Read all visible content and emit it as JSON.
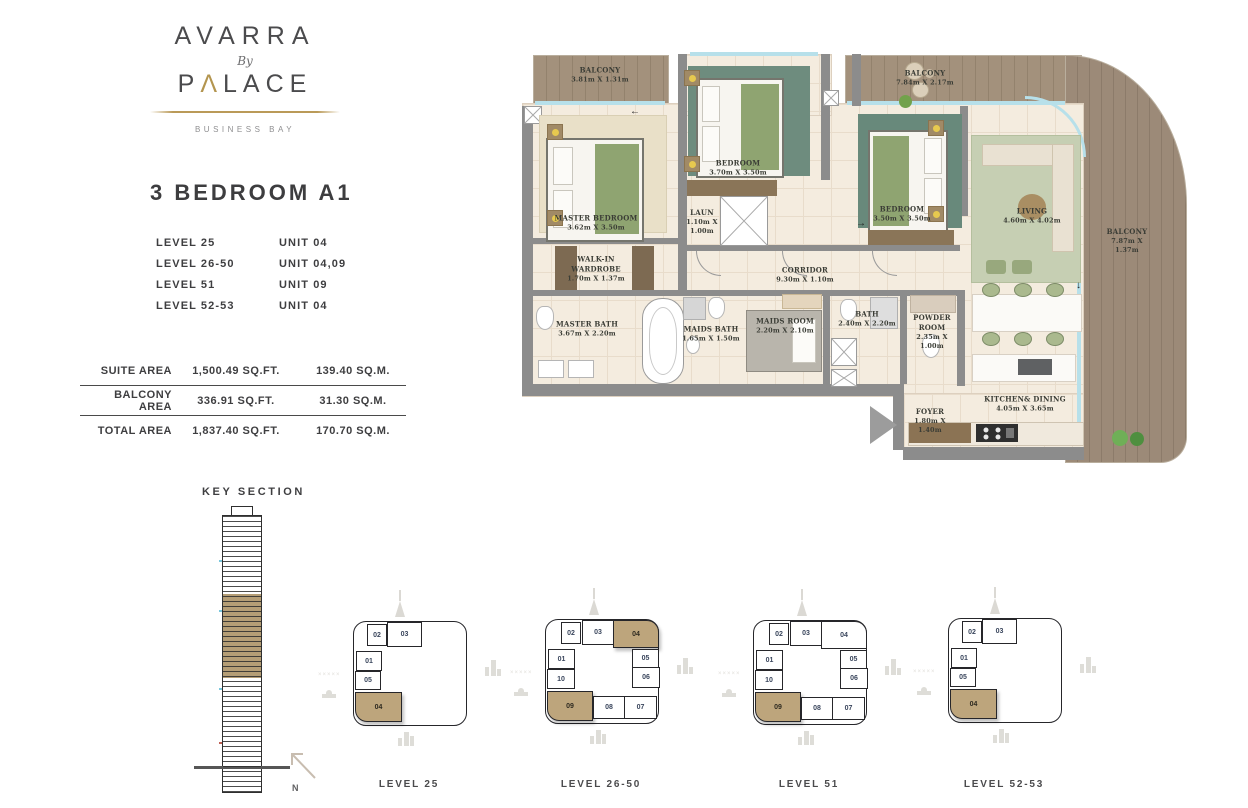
{
  "brand": {
    "name": "AVARRA",
    "by": "By",
    "palace_p": "P",
    "palace_arch": "Λ",
    "palace_rest": "LACE",
    "location": "BUSINESS BAY"
  },
  "page": {
    "title": "3 BEDROOM A1"
  },
  "levels": [
    {
      "level": "LEVEL 25",
      "unit": "UNIT 04"
    },
    {
      "level": "LEVEL 26-50",
      "unit": "UNIT 04,09"
    },
    {
      "level": "LEVEL 51",
      "unit": "UNIT 09"
    },
    {
      "level": "LEVEL 52-53",
      "unit": "UNIT 04"
    }
  ],
  "areas": [
    {
      "label": "SUITE AREA",
      "sqft": "1,500.49 SQ.FT.",
      "sqm": "139.40 SQ.M."
    },
    {
      "label": "BALCONY AREA",
      "sqft": "336.91 SQ.FT.",
      "sqm": "31.30 SQ.M."
    },
    {
      "label": "TOTAL AREA",
      "sqft": "1,837.40 SQ.FT.",
      "sqm": "170.70 SQ.M."
    }
  ],
  "key_section_title": "KEY SECTION",
  "compass": "N",
  "plan": {
    "rooms": [
      {
        "name": "BALCONY",
        "dims": "3.81m X 1.31m"
      },
      {
        "name": "BEDROOM",
        "dims": "3.70m X 3.50m"
      },
      {
        "name": "BALCONY",
        "dims": "7.84m X 2.17m"
      },
      {
        "name": "MASTER BEDROOM",
        "dims": "3.62m X 3.50m"
      },
      {
        "name": "BEDROOM",
        "dims": "3.50m X 3.50m"
      },
      {
        "name": "LIVING",
        "dims": "4.60m X 4.02m"
      },
      {
        "name": "BALCONY",
        "dims": "7.87m X 1.37m"
      },
      {
        "name": "WALK-IN WARDROBE",
        "dims": "1.70m X 1.37m"
      },
      {
        "name": "LAUN",
        "dims": "1.10m X 1.00m"
      },
      {
        "name": "CORRIDOR",
        "dims": "9.30m X 1.10m"
      },
      {
        "name": "MASTER BATH",
        "dims": "3.67m X 2.20m"
      },
      {
        "name": "MAIDS BATH",
        "dims": "1.65m X 1.50m"
      },
      {
        "name": "MAIDS ROOM",
        "dims": "2.20m X 2.10m"
      },
      {
        "name": "BATH",
        "dims": "2.40m X 2.20m"
      },
      {
        "name": "POWDER ROOM",
        "dims": "2.35m X 1.00m"
      },
      {
        "name": "FOYER",
        "dims": "1.80m X 1.40m"
      },
      {
        "name": "KITCHEN& DINING",
        "dims": "4.05m X 3.65m"
      }
    ]
  },
  "key_plans": [
    {
      "label": "LEVEL 25",
      "units": [
        {
          "id": "02",
          "highlight": false
        },
        {
          "id": "03",
          "highlight": false
        },
        {
          "id": "01",
          "highlight": false
        },
        {
          "id": "05",
          "highlight": false
        },
        {
          "id": "04",
          "highlight": true
        }
      ]
    },
    {
      "label": "LEVEL 26-50",
      "units": [
        {
          "id": "02",
          "highlight": false
        },
        {
          "id": "03",
          "highlight": false
        },
        {
          "id": "04",
          "highlight": true
        },
        {
          "id": "01",
          "highlight": false
        },
        {
          "id": "10",
          "highlight": false
        },
        {
          "id": "05",
          "highlight": false
        },
        {
          "id": "06",
          "highlight": false
        },
        {
          "id": "09",
          "highlight": true
        },
        {
          "id": "08",
          "highlight": false
        },
        {
          "id": "07",
          "highlight": false
        }
      ]
    },
    {
      "label": "LEVEL 51",
      "units": [
        {
          "id": "02",
          "highlight": false
        },
        {
          "id": "03",
          "highlight": false
        },
        {
          "id": "04",
          "highlight": false
        },
        {
          "id": "01",
          "highlight": false
        },
        {
          "id": "10",
          "highlight": false
        },
        {
          "id": "05",
          "highlight": false
        },
        {
          "id": "06",
          "highlight": false
        },
        {
          "id": "09",
          "highlight": true
        },
        {
          "id": "08",
          "highlight": false
        },
        {
          "id": "07",
          "highlight": false
        }
      ]
    },
    {
      "label": "LEVEL 52-53",
      "units": [
        {
          "id": "02",
          "highlight": false
        },
        {
          "id": "03",
          "highlight": false
        },
        {
          "id": "01",
          "highlight": false
        },
        {
          "id": "05",
          "highlight": false
        },
        {
          "id": "04",
          "highlight": true
        }
      ]
    }
  ],
  "colors": {
    "gold": "#b3954f",
    "highlight": "#bda57c",
    "wall": "#8c8c8c",
    "wood": "#a3917c",
    "glazing": "#b7e0ea",
    "floor": "#f4ecdf"
  }
}
